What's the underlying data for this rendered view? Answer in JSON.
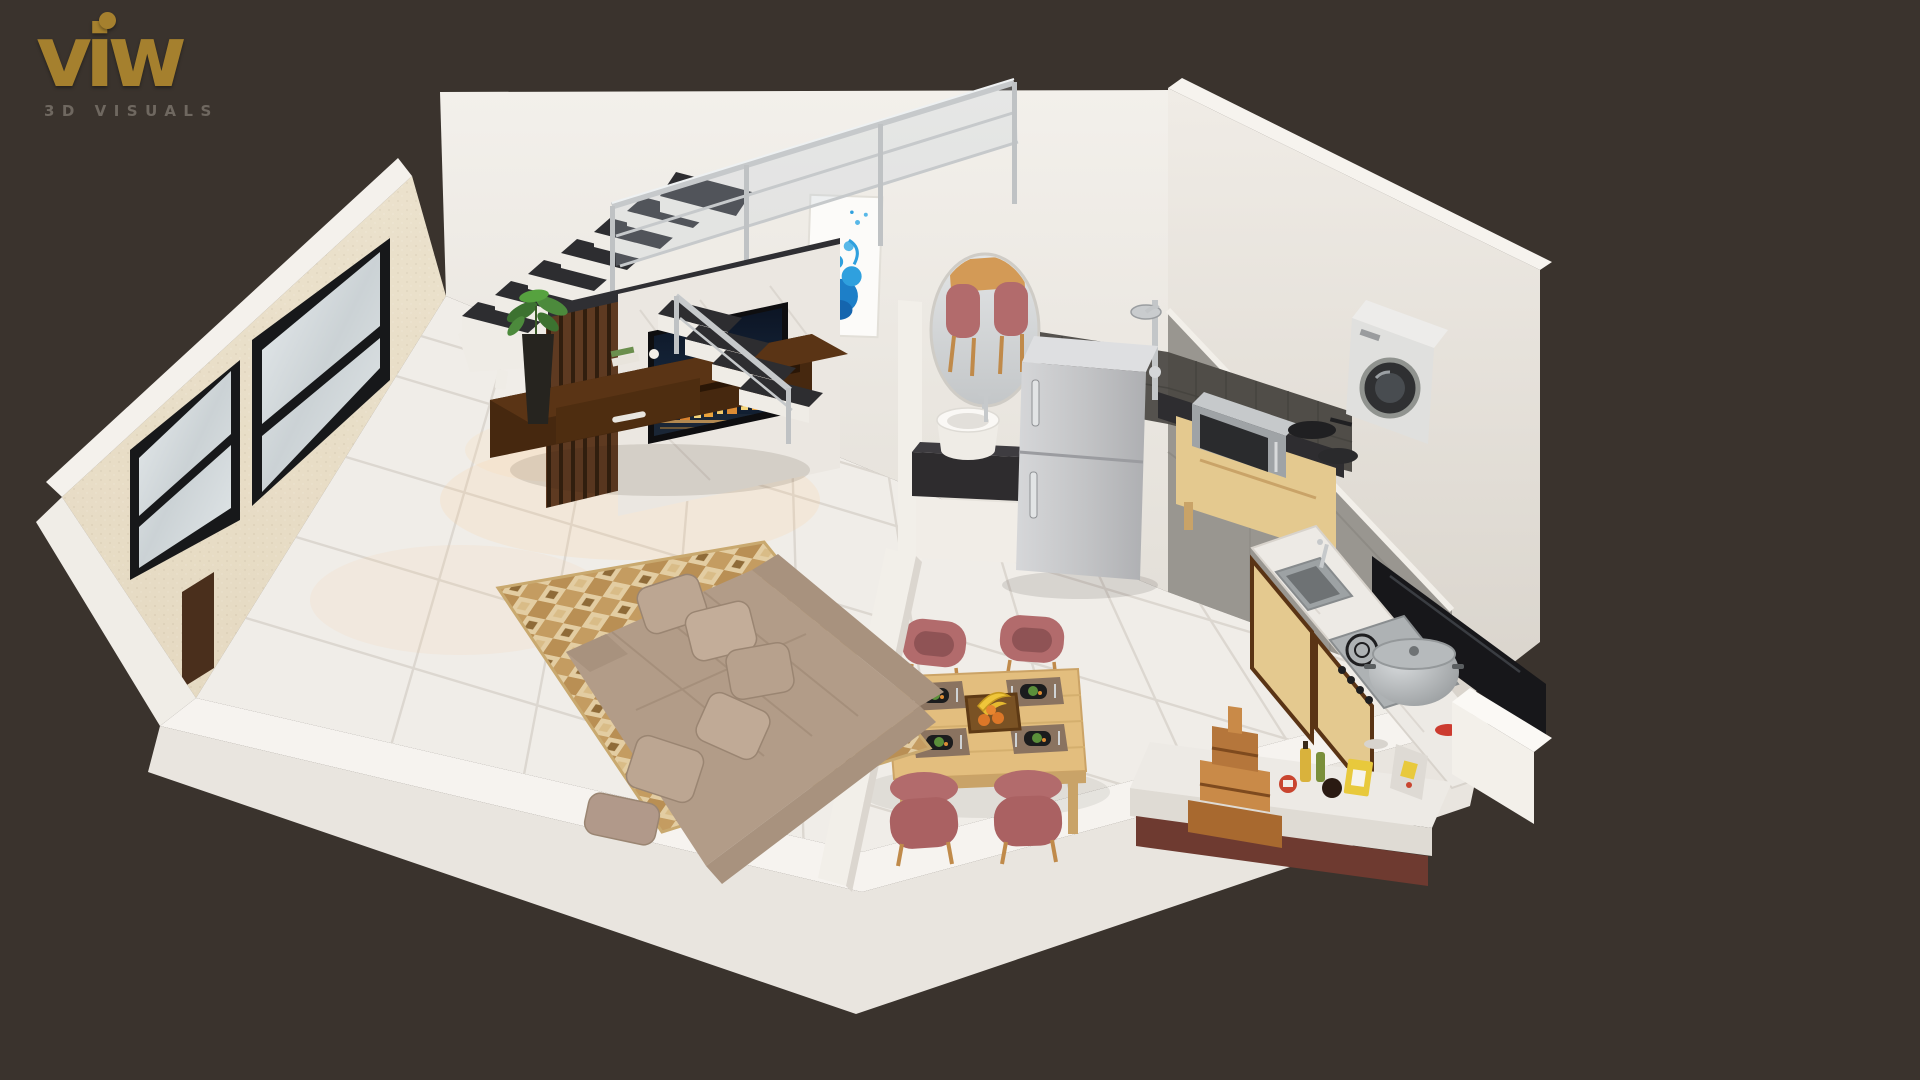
{
  "logo": {
    "brand": "viw",
    "tagline": "3D VISUALS",
    "accent_color": "#A5802E",
    "tagline_color": "#6F6860"
  },
  "canvas": {
    "background": "#3A332D"
  },
  "scene": {
    "type": "isometric-3d-interior-render",
    "description": "Dollhouse cutaway 3D render of a one-room apartment with living room, dining area, kitchen and staircase",
    "palette": {
      "wall_white": "#F0EDE7",
      "accent_wall_beige": "#E9DFC9",
      "floor_tile": "#F0EDE8",
      "tile_grout": "#DCD7D0",
      "stair_marble": "#2D2D30",
      "chrome": "#C6C9CB",
      "tv_console_wood": "#4A2C12",
      "slat_wall_wood": "#5E3A21",
      "sofa_taupe": "#B29C88",
      "rug_beige": "#E3CDA2",
      "rug_brown": "#B98F54",
      "coffee_table_wood": "#3A2313",
      "dining_table_wood": "#E3BE7E",
      "chair_mauve": "#B26B6C",
      "kitchen_cabinet_wood": "#E4C98F",
      "counter_marble": "#EDEAE5",
      "backsplash_dark": "#57544E",
      "appliance_steel": "#C6C7C9",
      "art_blue": "#2496DB"
    },
    "objects": [
      "l-shaped-staircase",
      "chrome-glass-railing",
      "blue-splash-wall-art",
      "oval-mirror",
      "round-washbasin",
      "wood-slat-accent-wall",
      "marble-tv-panel",
      "wall-tv-city-skyline",
      "floating-tv-console",
      "potted-plant",
      "checkered-area-rug",
      "coffee-table",
      "l-shaped-sofa",
      "throw-pillows",
      "half-partition-wall",
      "dining-table-for-four",
      "mauve-dining-chairs",
      "placemats-with-plates",
      "fruit-tray",
      "double-door-refrigerator",
      "microwave-on-cabinet",
      "frying-pans",
      "washing-machine",
      "shower-mixer",
      "kitchen-island",
      "inset-sink",
      "gas-hob",
      "cooking-pot",
      "tall-black-cabinet",
      "wooden-mandir-shelf",
      "grocery-items",
      "window-wall",
      "door-frame"
    ]
  }
}
